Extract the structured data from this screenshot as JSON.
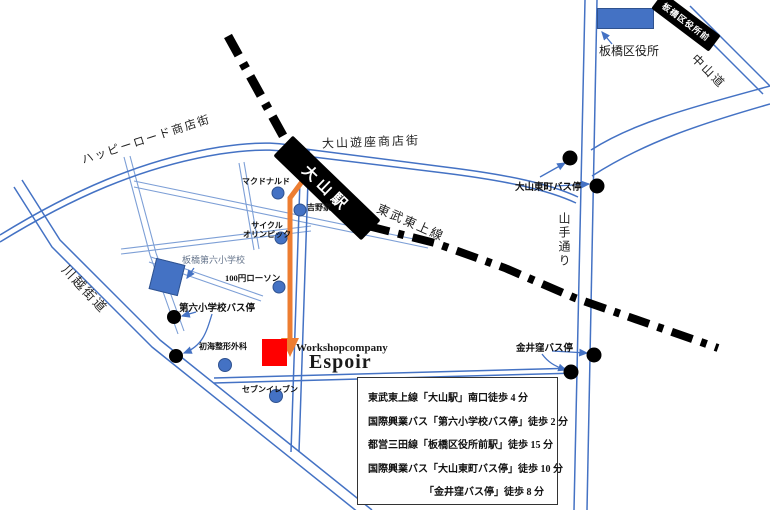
{
  "map_type": "access-map",
  "colors": {
    "road_blue": "#4472C4",
    "road_blue_light": "#7d9fd6",
    "railway_black": "#000000",
    "route_orange": "#ED7D31",
    "destination_red": "#FF0000",
    "building_blue": "#4472C4"
  },
  "railway": {
    "line_label": "東武東上線",
    "stations": {
      "oyama": "大山駅",
      "itabashi_kuyakusho_mae": "板橋区役所前"
    }
  },
  "roads": {
    "happy_road": "ハッピーロード商店街",
    "yuza": "大山遊座商店街",
    "kawagoe": "川越街道",
    "yamate": "山手通り",
    "nakasendo": "中山道"
  },
  "destination": {
    "company": "Workshopcompany",
    "name": "Espoir"
  },
  "landmarks": {
    "ward_office": "板橋区役所",
    "school": "板橋第六小学校",
    "mcdonalds": "マクドナルド",
    "yoshinoya": "吉野家",
    "cycle_olympic_line1": "サイクル",
    "cycle_olympic_line2": "オリンピック",
    "lawson_100": "100円ローソン",
    "clinic": "初海整形外科",
    "seven_eleven": "セブンイレブン"
  },
  "bus_stops": {
    "dairoku_shogakko": "第六小学校バス停",
    "oyama_higashicho": "大山東町バス停",
    "kanaikubo": "金井窪バス停"
  },
  "access_box": {
    "lines": [
      "東武東上線「大山駅」南口徒歩 4 分",
      "国際興業バス「第六小学校バス停」徒歩 2 分",
      "都営三田線「板橋区役所前駅」徒歩 15 分",
      "国際興業バス「大山東町バス停」徒歩 10 分",
      "「金井窪バス停」徒歩 8 分"
    ]
  }
}
